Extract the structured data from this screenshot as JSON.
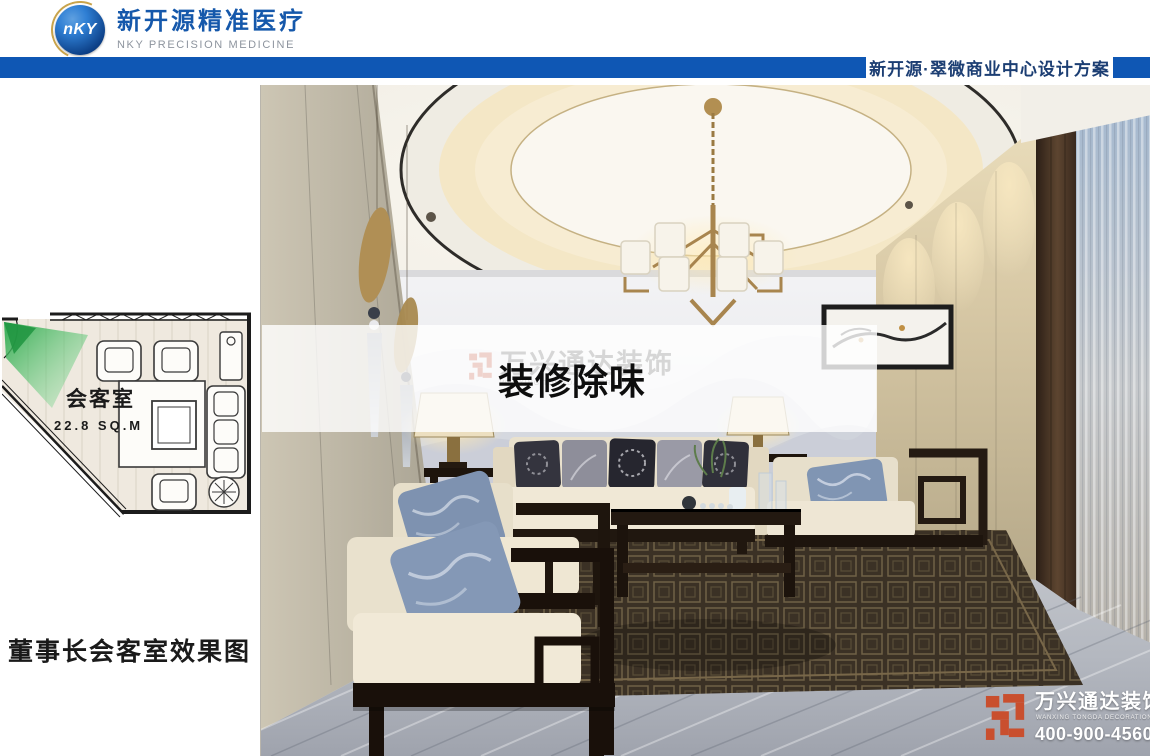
{
  "header": {
    "logo_monogram": "nKY",
    "brand_cn": "新开源精准医疗",
    "brand_en": "NKY PRECISION MEDICINE"
  },
  "topbar": {
    "project_title": "新开源·翠微商业中心设计方案"
  },
  "floorplan": {
    "room_label": "会客室",
    "room_area": "22.8 SQ.M"
  },
  "caption": {
    "text": "董事长会客室效果图"
  },
  "overlay_banner": {
    "text": "装修除味"
  },
  "watermark": {
    "company_cn": "万兴通达装饰",
    "company_en": "WANXING TONGDA DECORATION",
    "phone": "400-900-4560"
  },
  "colors": {
    "topbar_blue": "#0f57b4",
    "brand_blue": "#1558ab",
    "watermark_red": "#c94f2e",
    "plan_view_green": "#3aa54a"
  }
}
